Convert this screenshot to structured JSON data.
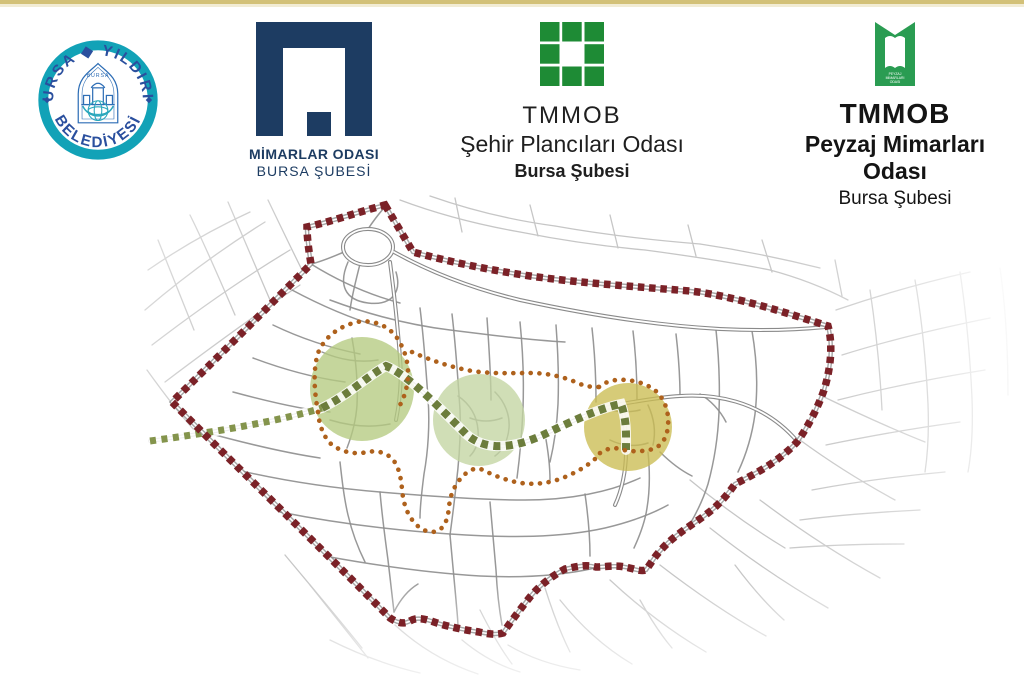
{
  "page": {
    "top_bar_color": "#d3c178",
    "top_bar_inner_color": "#f2ecd4",
    "background": "#ffffff"
  },
  "header": {
    "municipality": {
      "arc_top": "BURSA ◆ YILDIRIM",
      "arc_bottom": "BELEDİYESİ",
      "center_label": "BURSA",
      "ring_color": "#12a2b7",
      "text_color": "#2a4f9e",
      "emblem_color": "#2d6db5",
      "globe_color": "#2aa7bc"
    },
    "mimarlar": {
      "line1": "MİMARLAR ODASI",
      "line2": "BURSA ŞUBESİ",
      "color": "#1d3c62"
    },
    "sehir": {
      "line1": "TMMOB",
      "line2": "Şehir Plancıları Odası",
      "line3": "Bursa Şubesi",
      "logo_color": "#1e8b35",
      "text_color": "#1f1f1f"
    },
    "peyzaj": {
      "line1": "TMMOB",
      "line2": "Peyzaj Mimarları Odası",
      "line3": "Bursa Şubesi",
      "logo_color": "#2a9c52",
      "text_color": "#141414",
      "inner_lines": [
        "PEYZAJ",
        "MİMARLARI",
        "ODASI"
      ]
    }
  },
  "map": {
    "boundary_color": "#7b2127",
    "street_color": "#8f8f8f",
    "street_faded_color": "#c6c6c6",
    "route_main_color": "#6c7d3c",
    "route_main_light_color": "#84944c",
    "route_secondary_color": "#ae611c",
    "zones": [
      {
        "name": "west-zone",
        "fill": "#b5cb80"
      },
      {
        "name": "center-zone",
        "fill": "#c3d5a1"
      },
      {
        "name": "east-zone",
        "fill": "#cabd52"
      }
    ]
  }
}
